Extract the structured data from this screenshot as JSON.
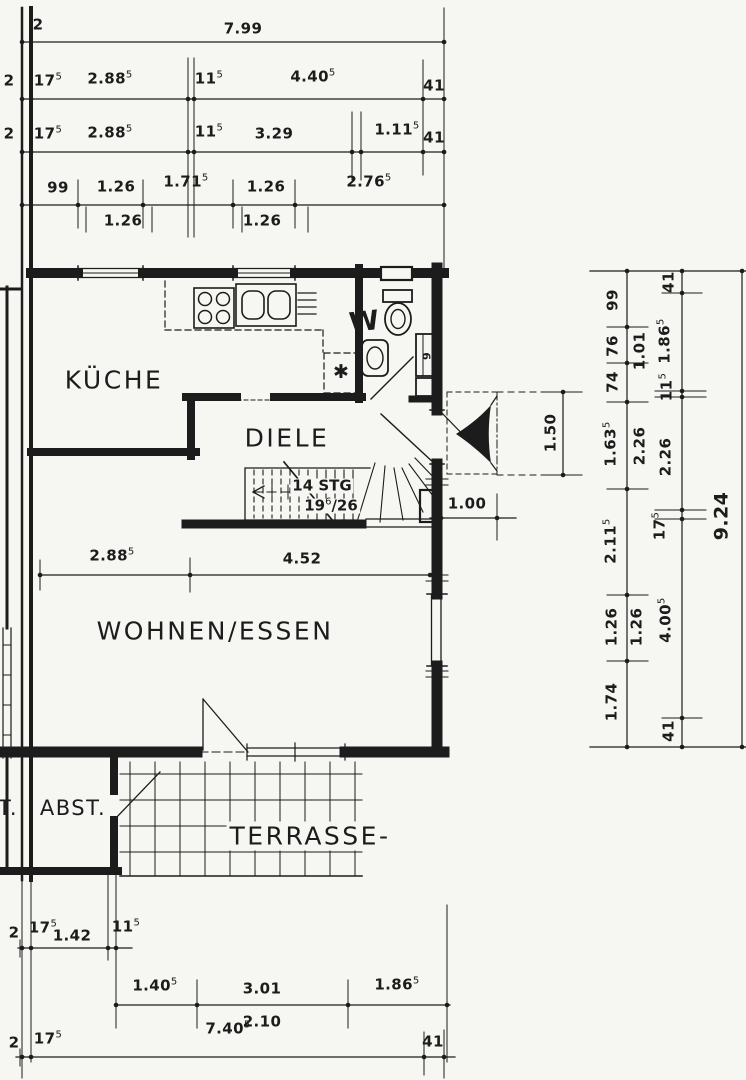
{
  "colors": {
    "ink": "#1c1c1c",
    "paper": "#f6f6f2"
  },
  "rooms": {
    "kueche": "KÜCHE",
    "diele": "DIELE",
    "wohnen": "WOHNEN/ESSEN",
    "abst": "ABST.",
    "terrasse": "TERRASSE-",
    "wc_w": "W",
    "neighbor": "T.",
    "closet": "9"
  },
  "stairs": {
    "stg": {
      "v": "14 STG"
    },
    "ratio": {
      "v": "19",
      "s": "6",
      "v2": "/26"
    }
  },
  "symbols": {
    "asterisk": "✱"
  },
  "dims": {
    "t1": [
      {
        "v": "2"
      },
      {
        "v": "7.99"
      }
    ],
    "t2": [
      {
        "v": "2"
      },
      {
        "v": "17",
        "s": "5"
      },
      {
        "v": "2.88",
        "s": "5"
      },
      {
        "v": "11",
        "s": "5"
      },
      {
        "v": "4.40",
        "s": "5"
      },
      {
        "v": "41"
      }
    ],
    "t3": [
      {
        "v": "2"
      },
      {
        "v": "17",
        "s": "5"
      },
      {
        "v": "2.88",
        "s": "5"
      },
      {
        "v": "11",
        "s": "5"
      },
      {
        "v": "3.29"
      },
      {
        "v": "1.11",
        "s": "5"
      },
      {
        "v": "41"
      }
    ],
    "t4": [
      {
        "v": "99"
      },
      {
        "v": "1.26"
      },
      {
        "v": "1.71",
        "s": "5"
      },
      {
        "v": "1.26"
      },
      {
        "v": "2.76",
        "s": "5"
      }
    ],
    "t4b": [
      {
        "v": "1.26"
      },
      {
        "v": "1.26"
      }
    ],
    "plan": [
      {
        "v": "2.88",
        "s": "5"
      },
      {
        "v": "4.52"
      },
      {
        "v": "1.00"
      },
      {
        "v": "1.50"
      }
    ],
    "rA": [
      {
        "v": "99"
      },
      {
        "v": "76"
      },
      {
        "v": "74"
      },
      {
        "v": "1.63",
        "s": "5"
      },
      {
        "v": "2.11",
        "s": "5"
      },
      {
        "v": "1.26"
      },
      {
        "v": "1.74"
      }
    ],
    "rA2": [
      {
        "v": "1.01"
      },
      {
        "v": "2.26"
      },
      {
        "v": "1.26"
      }
    ],
    "rB": [
      {
        "v": "41"
      },
      {
        "v": "1.86",
        "s": "5"
      },
      {
        "v": "11",
        "s": "5"
      },
      {
        "v": "2.26"
      },
      {
        "v": "17",
        "s": "5"
      },
      {
        "v": "4.00",
        "s": "5"
      },
      {
        "v": "41"
      }
    ],
    "rC": [
      {
        "v": "9.24"
      }
    ],
    "b1": [
      {
        "v": "2"
      },
      {
        "v": "17",
        "s": "5"
      },
      {
        "v": "1.42"
      },
      {
        "v": "11",
        "s": "5"
      }
    ],
    "b2": [
      {
        "v": "1.40",
        "s": "5"
      },
      {
        "v": "3.01"
      },
      {
        "v": "1.86",
        "s": "5"
      }
    ],
    "b2b": [
      {
        "v": "2.10"
      }
    ],
    "b3": [
      {
        "v": "2"
      },
      {
        "v": "17",
        "s": "5"
      },
      {
        "v": "7.40",
        "s": "5"
      },
      {
        "v": "41"
      }
    ]
  }
}
